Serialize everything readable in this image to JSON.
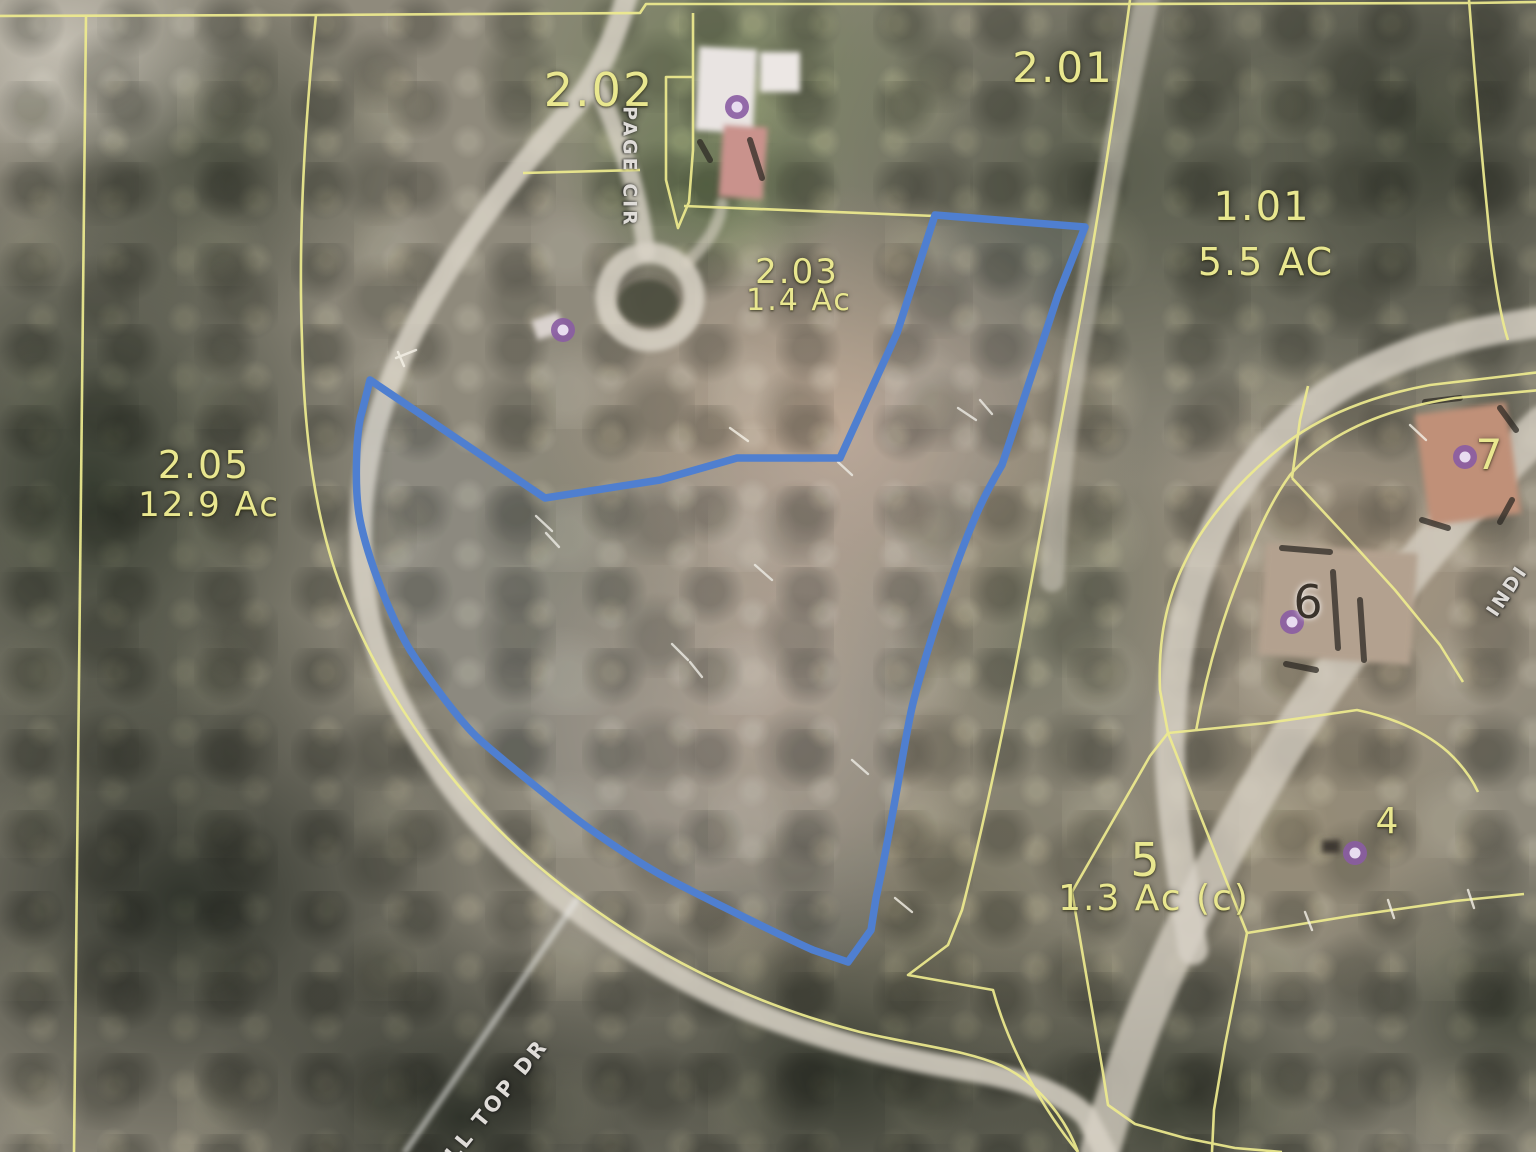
{
  "map": {
    "view_type": "aerial-parcel-map",
    "parcels": [
      {
        "id": "2.02",
        "area": ""
      },
      {
        "id": "2.01",
        "area": ""
      },
      {
        "id": "1.01",
        "area": "5.5 AC"
      },
      {
        "id": "2.03",
        "area": "1.4 Ac"
      },
      {
        "id": "2.05",
        "area": "12.9 Ac"
      },
      {
        "id": "5",
        "area": "1.3 Ac (c)"
      },
      {
        "id": "4",
        "area": ""
      },
      {
        "id": "6",
        "area": ""
      },
      {
        "id": "7",
        "area": ""
      }
    ],
    "roads": [
      {
        "name": "PAGE CIR"
      },
      {
        "name": "LL TOP DR"
      },
      {
        "name": "INDI"
      }
    ],
    "house_marker_count": 5,
    "colors": {
      "parcel_line": "#eeeb8f",
      "selected_parcel_outline": "#4f7fd0",
      "house_marker": "#8a5ca3",
      "road_surface": "#d8d2c5"
    }
  }
}
